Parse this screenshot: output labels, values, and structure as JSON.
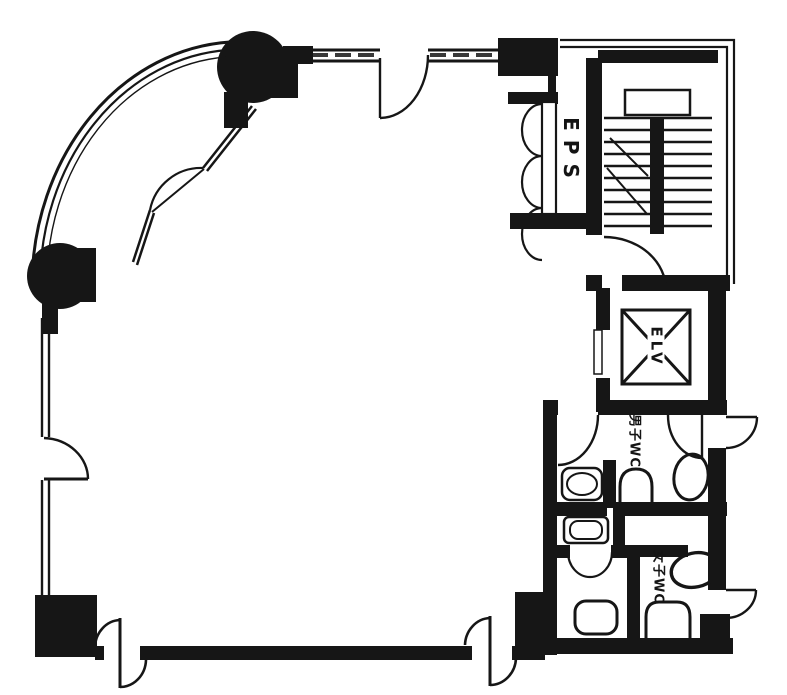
{
  "drawing": {
    "type": "architectural-floor-plan",
    "style": "scanned black-and-white building floor plan"
  },
  "labels": {
    "eps": "EPS",
    "elevator": "ELV",
    "mens_wc": "男子WC",
    "womens_wc": "女子WC"
  },
  "rooms": [
    {
      "name": "main-room",
      "label": ""
    },
    {
      "name": "stairwell",
      "label": ""
    },
    {
      "name": "eps-shaft",
      "label": "EPS"
    },
    {
      "name": "elevator-shaft",
      "label": "ELV"
    },
    {
      "name": "mens-wc",
      "label": "男子WC"
    },
    {
      "name": "womens-wc",
      "label": "女子WC"
    }
  ],
  "colors": {
    "ink": "#161616",
    "paper": "#ffffff"
  }
}
